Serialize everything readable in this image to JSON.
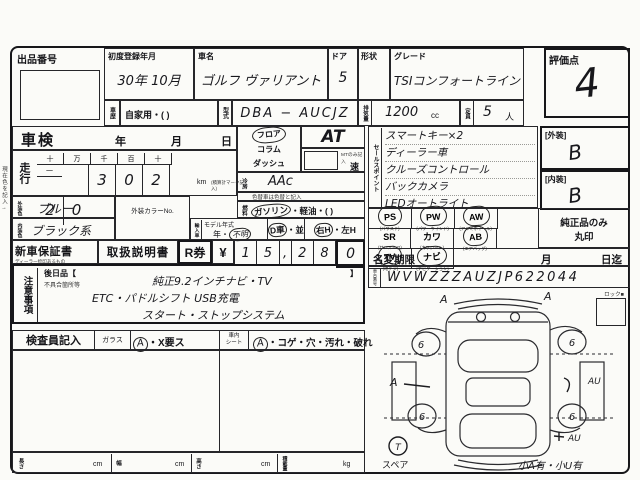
{
  "form": {
    "side_note": "現在色を記入→",
    "auction": {
      "label": "出品番号"
    },
    "reg": {
      "label": "初度登録年月",
      "value": "30年 10月"
    },
    "car": {
      "label": "車名",
      "value": "ゴルフ ヴァリアント"
    },
    "door": {
      "label": "ドア",
      "value": "5"
    },
    "shape": {
      "label": "形状",
      "value": ""
    },
    "grade": {
      "label": "グレード",
      "value": "TSIコンフォートライン"
    },
    "score": {
      "label": "評価点",
      "value": "4"
    },
    "history": {
      "label": "車歴",
      "value": "自家用・(        )"
    },
    "model": {
      "label": "型式",
      "value": "DBA − AUCJZ"
    },
    "disp": {
      "label": "排気量",
      "value": "1200",
      "unit": "cc"
    },
    "capacity": {
      "label": "定員",
      "value": "5",
      "unit": "人"
    },
    "shaken": {
      "label": "車検",
      "year": "年",
      "month": "月",
      "day": "日"
    },
    "mileage": {
      "label": "走行",
      "headers": [
        "十",
        "万",
        "千",
        "百",
        "十",
        "一"
      ],
      "digits": [
        "",
        "3",
        "0",
        "2",
        "2",
        "0"
      ],
      "unit": "km",
      "unit_note": "(積算計マーク記入)"
    },
    "shift": {
      "opt1": "フロア",
      "opt2": "コラム",
      "opt3": "ダッシュ",
      "at": "AT",
      "mt_note": "MTのみ記入",
      "speed": "速",
      "opt1_circled": true
    },
    "ac": {
      "label": "冷房",
      "value": "AAc"
    },
    "color_note": "色替車は色替と記入",
    "fuel": {
      "label": "燃料",
      "gas": "ガソリン",
      "rest": "・軽油・(      )",
      "gas_circled": true
    },
    "ext_color": {
      "label": "外装色",
      "value": "ブルー"
    },
    "int_color": {
      "label": "内装色",
      "value": "ブラック系"
    },
    "color_no": {
      "label": "外装カラーNo."
    },
    "import": {
      "label": "輸入車",
      "my_label": "モデル年式",
      "year": "年・",
      "unknown": "不明",
      "d": "D車",
      "heikou": "・並",
      "rh": "右H",
      "lh": "・左H",
      "unknown_circled": true,
      "d_circled": true,
      "rh_circled": true
    },
    "docs": {
      "warranty": "新車保証書",
      "warranty_sub": "ディーラー捺印あるもの",
      "manual": "取扱説明書",
      "r_label": "R券",
      "yen": "¥",
      "digits": [
        "1",
        "5",
        ",",
        "2",
        "8",
        "0"
      ]
    },
    "sales": {
      "label": "セールスポイント",
      "lines": [
        "スマートキー×2",
        "ディーラー車",
        "クルーズコントロール",
        "バックカメラ",
        "LEDオートライト"
      ]
    },
    "ext_grade": {
      "label": "[外装]",
      "value": "B"
    },
    "int_grade": {
      "label": "[内装]",
      "value": "B"
    },
    "equipment": {
      "note1": "純正品のみ",
      "note2": "丸印",
      "items": [
        {
          "code": "PS",
          "sub": "(パワステ)",
          "circled": true
        },
        {
          "code": "PW",
          "sub": "(パワーウインド)",
          "circled": true
        },
        {
          "code": "AW",
          "sub": "(アルミホイール)",
          "circled": true
        },
        {
          "code": "SR",
          "sub": "(サンルーフ)",
          "circled": false
        },
        {
          "code": "カワ",
          "sub": "(カワシート)",
          "circled": false
        },
        {
          "code": "AB",
          "sub": "(エアバッグ)",
          "circled": true
        },
        {
          "code": "TV",
          "sub": "(地デジ)",
          "circled": true
        },
        {
          "code": "ナビ",
          "sub": "(ナビゲーション)",
          "circled": true
        }
      ]
    },
    "name_change": {
      "label": "名変期限",
      "month": "月",
      "until": "日迄"
    },
    "chassis": {
      "label": "車台番号",
      "value": "WVWZZZAUZJP622044"
    },
    "notes": {
      "label": "注意事項",
      "later": "後日品【",
      "later_close": "】",
      "defect": "不具合箇所等",
      "lines": [
        "純正9.2インチナビ・TV",
        "ETC・パドルシフト USB充電",
        "スタート・ストップシステム"
      ]
    },
    "inspector": {
      "label": "検査員記入",
      "glass_label": "ガラス",
      "glass_mark": "A",
      "glass_rest": "・X要ス",
      "seat_label1": "車内",
      "seat_label2": "シート",
      "seat_mark": "A",
      "seat_rest": "・コゲ・穴・汚れ・破れ"
    },
    "dims": {
      "length": "長さ",
      "width": "幅",
      "height": "高さ",
      "load": "積載量",
      "cm": "cm",
      "kg": "kg"
    },
    "diagram": {
      "lock": "ロック■",
      "wheel": "6",
      "front_left": "A",
      "front_right": "A",
      "left": "A",
      "right1": "AU",
      "right2": "AU",
      "spare_mark": "T",
      "spare": "スペア",
      "note": "小A有・小U有"
    }
  }
}
